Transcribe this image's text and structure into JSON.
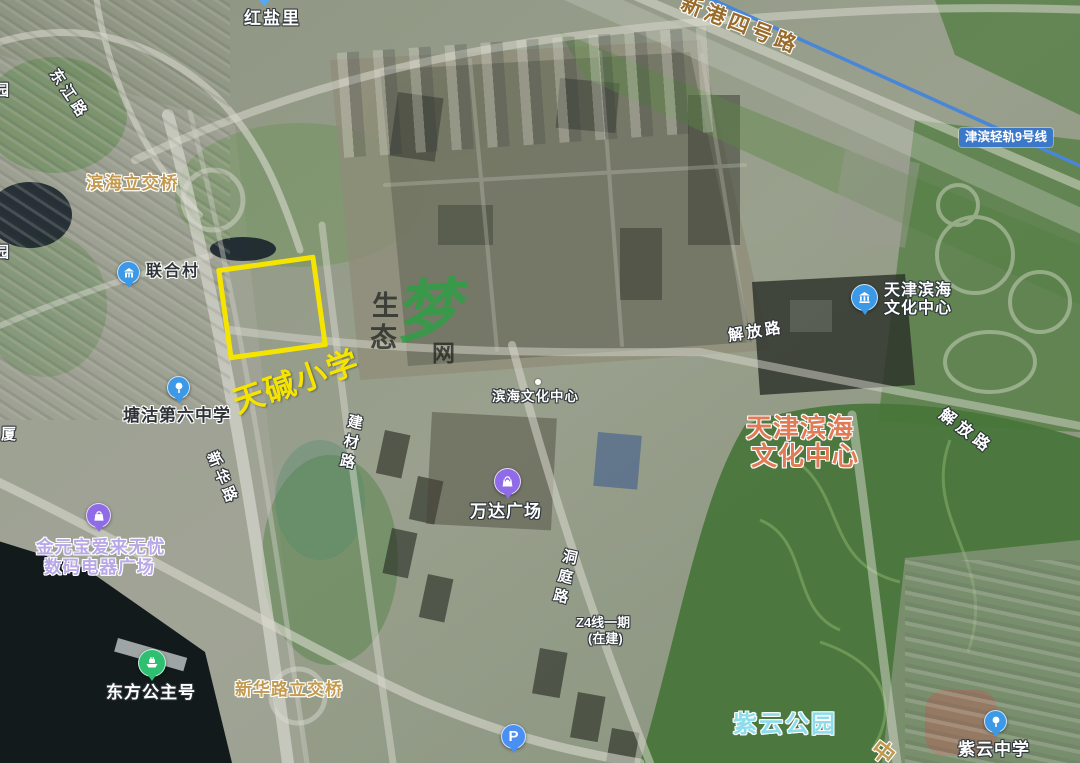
{
  "app": {
    "type": "satellite-map-view"
  },
  "colors": {
    "highlight_yellow": "#F5E400",
    "poi_big_orange": "#E07B55",
    "park_teal": "#8CDCEC",
    "rail_badge_blue": "#3C78C8",
    "rail_line_blue": "#4A86D8",
    "icon_blue": "#3B99E8",
    "icon_light_blue": "#4A90F4",
    "icon_purple": "#8F6BE8",
    "icon_green": "#2FBF71",
    "bridge_label_tan": "#C49A4E",
    "highway_label_brown": "#9A6C2C",
    "mall_label_lavender": "#B9A8E8",
    "watermark_green": "#2F9E44"
  },
  "roads": {
    "dongjiang": "东江路",
    "xinhua": "新华路",
    "jiancai": "建材路",
    "dongting": "洞庭路",
    "jiefang_west": "解放路",
    "jiefang_east": "解放路",
    "xingang4": "新港四号路",
    "zhong_partial": "中"
  },
  "bridges": {
    "binhai_interchange": "滨海立交桥",
    "xinhua_interchange": "新华路立交桥"
  },
  "edge_labels": {
    "yuan_top": "园",
    "yuan_mid": "园",
    "sha": "厦"
  },
  "pois": {
    "hongyanli": "红盐里",
    "lianhecun": "联合村",
    "tanggu_no6_school": "塘沽第六中学",
    "binhai_culture_center_small": "滨海文化中心",
    "wanda_plaza": "万达广场",
    "tj_binhai_culture_line1": "天津滨海",
    "tj_binhai_culture_line2": "文化中心",
    "jinyuanbao_line1": "金元宝爱来无忧",
    "jinyuanbao_line2": "数码电器广场",
    "oriental_princess": "东方公主号",
    "ziyun_school": "紫云中学",
    "parking": "P"
  },
  "annotations": {
    "highlight_school": "天碱小学"
  },
  "big_labels": {
    "tj_binhai_line1": "天津滨海",
    "tj_binhai_line2": "文化中心",
    "ziyun_park": "紫云公园"
  },
  "transit": {
    "rail9_badge": "津滨轻轨9号线",
    "z4_line1": "Z4线一期",
    "z4_line2": "(在建)"
  },
  "watermark": {
    "char1": "生",
    "char2": "态",
    "char3": "梦",
    "char4": "网"
  }
}
